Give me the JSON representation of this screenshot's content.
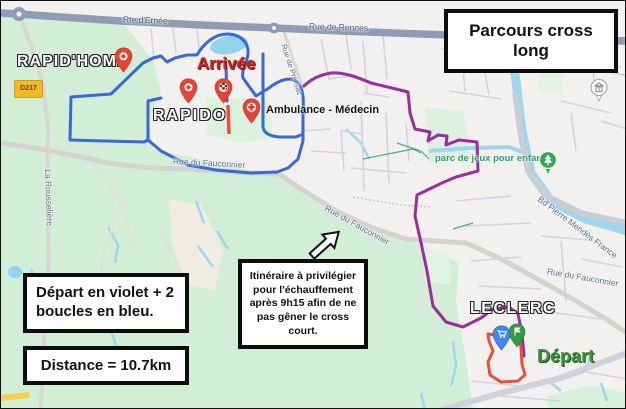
{
  "title": "Parcours cross long",
  "boxes": {
    "legend": "Départ en violet + 2 boucles en bleu.",
    "distance": "Distance = 10.7km",
    "warmup": "Itinéraire à privilégier pour l'échauffement après 9h15 afin de ne pas gêner le cross court."
  },
  "annotations": {
    "finish": "Arrivée",
    "start": "Départ",
    "medical": "Ambulance - Médecin"
  },
  "places": {
    "rapid_home": "RAPID'HOME",
    "rapido": "RAPIDO",
    "leclerc": "LECLERC",
    "park": "parc de jeux pour enfant"
  },
  "roads": {
    "rte_ernee": "Rte d'Ernée",
    "rue_de_rennes": "Rue de Rennes",
    "rue_du_fauconnier": "Rue du Fauconnier",
    "rue_de_pre_sac": "Rue de Pré Sac",
    "la_rousseliere": "La Rousselière",
    "bd_pierre_mendes_france": "Bd Pierre Mendès France",
    "d217": "D217"
  },
  "route_colors": {
    "start_violet": "#9b2d9f",
    "loops_blue": "#3a68d8",
    "finish_red": "#e8503c"
  }
}
